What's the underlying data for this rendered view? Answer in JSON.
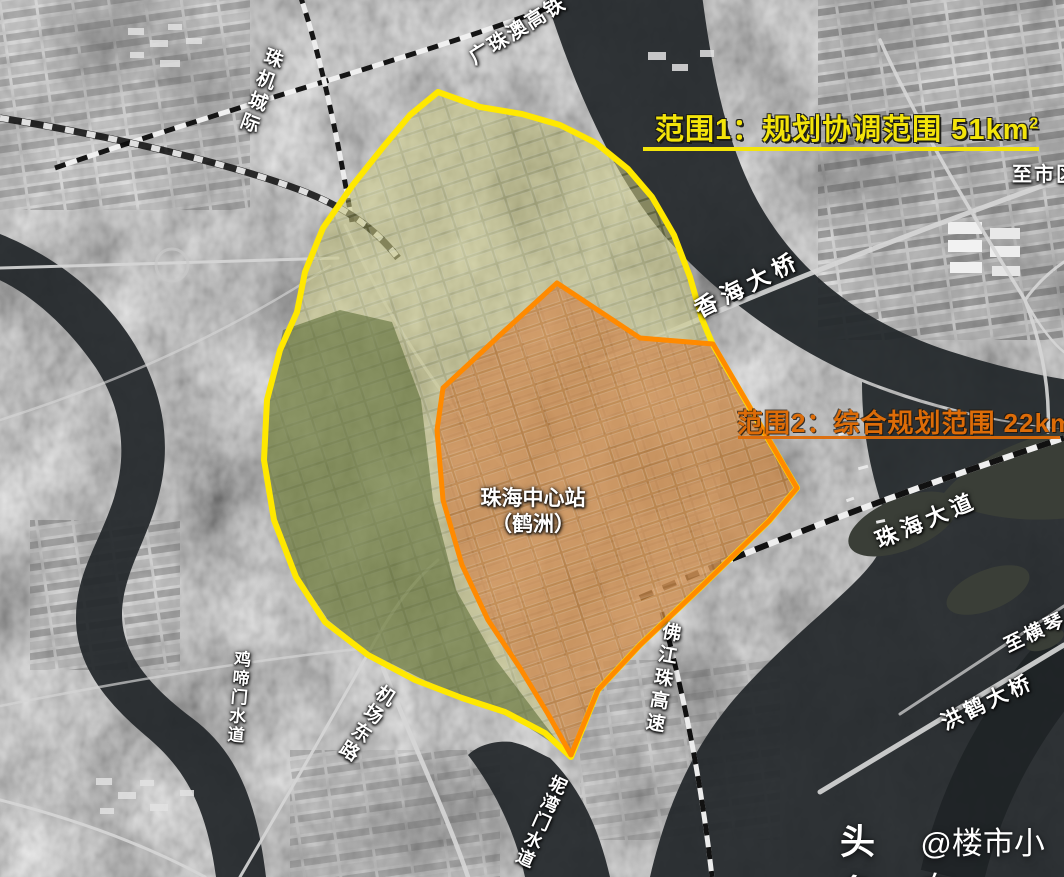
{
  "labels": {
    "railway_top": "广珠澳高铁",
    "railway_left": "珠机城际",
    "scope1": {
      "text": "范围1：规划协调范围 51km",
      "sup": "2"
    },
    "scope2": {
      "text": "范围2：综合规划范围 22km",
      "sup": "2"
    },
    "bridge_xianghai": "香海大桥",
    "to_city": "至市区",
    "station_line1": "珠海中心站",
    "station_line2": "（鹤洲）",
    "road_zhuhai_avenue": "珠海大道",
    "to_hengqin": "至横琴",
    "bridge_honghe": "洪鹤大桥",
    "expressway_fjz": "佛江珠高速",
    "road_airport_east": "机场东路",
    "waterway_jitimen": "鸡啼门水道",
    "waterway_niwanmen": "坭湾门水道"
  },
  "watermark": {
    "brand": "头条",
    "handle": "@楼市小向"
  },
  "colors": {
    "scope1_accent": "#f3e40a",
    "scope1_fill": "rgba(172,174,84,0.42)",
    "scope2_accent": "#ff8a00",
    "scope2_text": "#dd6c08",
    "scope2_fill": "rgba(190,86,16,0.5)"
  }
}
